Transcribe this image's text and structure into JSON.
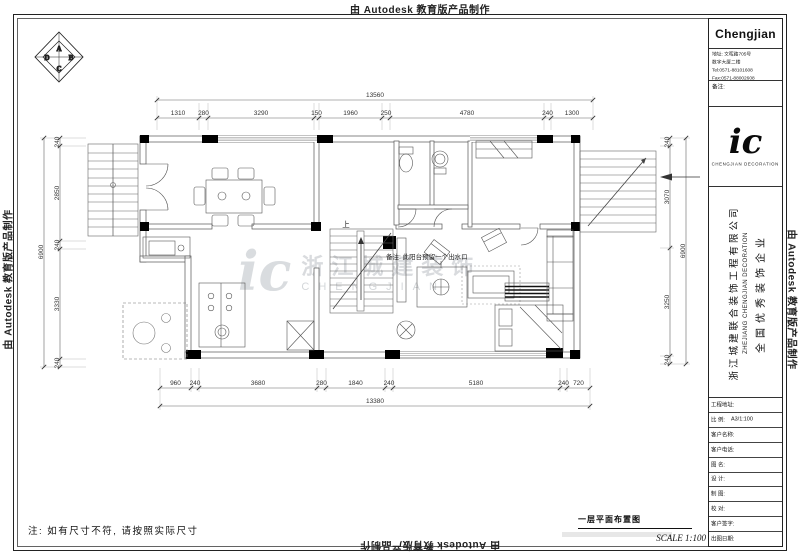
{
  "stamp": {
    "text": "由 Autodesk 教育版产品制作"
  },
  "compass": {
    "a": "A",
    "b": "B",
    "c": "C",
    "d": "D"
  },
  "title_block": {
    "company": "Chengjian",
    "address_line1": "地址: 文晖路705号",
    "address_line2": "数字大厦二楼",
    "tel": "Tel:0571-88101608",
    "fax": "Fax:0571-88002608",
    "remark_label": "备注:",
    "logo_script": "ic",
    "logo_caption": "CHENGJIAN DECORATION",
    "company_cn": "浙江城建联合装饰工程有限公司",
    "company_en": "ZHEJIANG CHENGJIAN DECORATION",
    "honor": "全国优秀装饰企业",
    "rows": [
      {
        "label": "工程地址:",
        "value": ""
      },
      {
        "label": "比 例:",
        "value": "A3/1:100"
      },
      {
        "label": "客户名称:",
        "value": ""
      },
      {
        "label": "客户电话:",
        "value": ""
      },
      {
        "label": "图 名:",
        "value": ""
      },
      {
        "label": "设 计:",
        "value": ""
      },
      {
        "label": "制 图:",
        "value": ""
      },
      {
        "label": "校 对:",
        "value": ""
      },
      {
        "label": "客户签字:",
        "value": ""
      },
      {
        "label": "出图日期:",
        "value": ""
      }
    ]
  },
  "drawing": {
    "title": "一层平面布置图",
    "scale": "SCALE 1:100",
    "bottom_note": "注: 如有尺寸不符, 请按照实际尺寸",
    "plan_note": "备注: 此阳台预留一个出水口",
    "stair_up": "上",
    "watermark_script": "ic",
    "watermark_cn": "浙江城建装饰",
    "watermark_en": "CHENGJIAN"
  },
  "dims": {
    "top": {
      "overall": "13560",
      "segments": [
        "1310",
        "280",
        "3290",
        "150",
        "1960",
        "250",
        "4780",
        "240",
        "1300"
      ]
    },
    "bottom": {
      "overall": "13380",
      "segments": [
        "960",
        "240",
        "3680",
        "280",
        "1840",
        "240",
        "5180",
        "240",
        "720"
      ]
    },
    "left": {
      "overall": "6900",
      "segments": [
        "240",
        "2850",
        "240",
        "3330",
        "240"
      ]
    },
    "right": {
      "overall": "6900",
      "segments": [
        "240",
        "3070",
        "3250",
        "240"
      ]
    }
  },
  "colors": {
    "ink": "#111111",
    "dimline": "#666666",
    "watermark": "#aab0b6"
  }
}
